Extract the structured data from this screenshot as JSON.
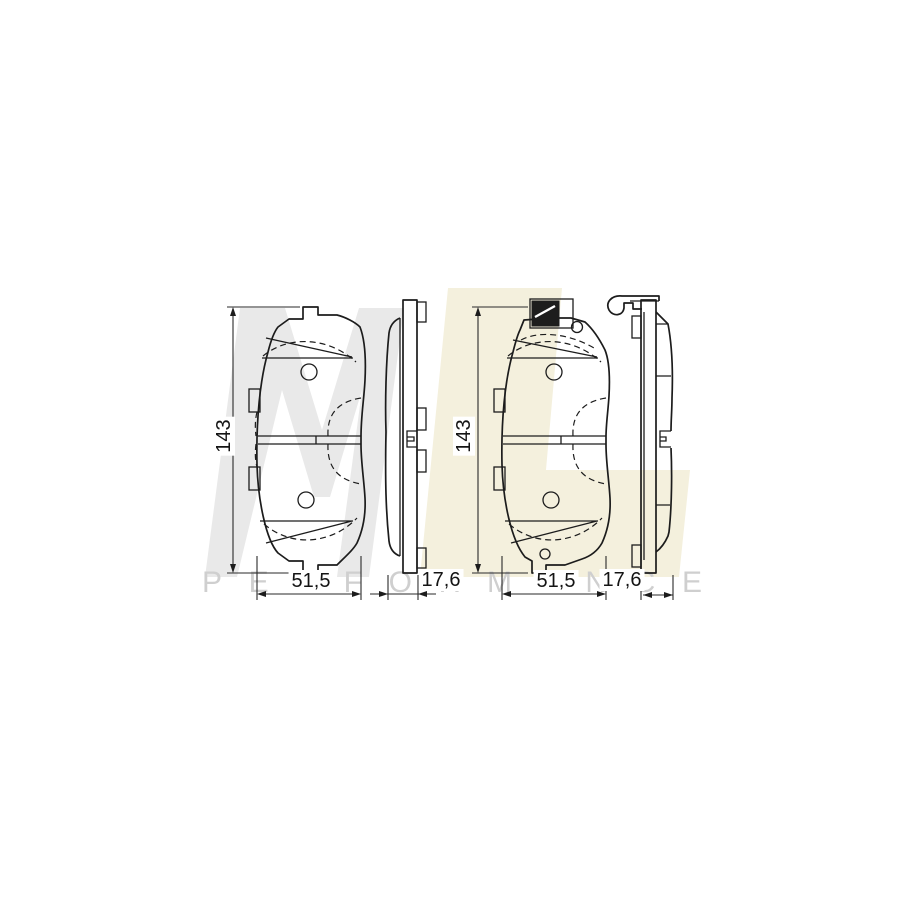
{
  "watermark": {
    "letter_m": "M",
    "letter_l": "L",
    "subtext": "PERFORMANCE",
    "color_m": "#e9e9e9",
    "color_l": "#f4f0dd",
    "color_subtext": "#cfcfcf"
  },
  "drawing": {
    "line_color": "#1c1c1c",
    "views": [
      {
        "id": "pad-front-outer",
        "height_label": "143",
        "width_label": "51,5"
      },
      {
        "id": "pad-side-outer",
        "thickness_label": "17,6"
      },
      {
        "id": "pad-front-inner",
        "height_label": "143",
        "width_label": "51,5"
      },
      {
        "id": "pad-side-inner",
        "thickness_label": "17,6"
      }
    ]
  }
}
